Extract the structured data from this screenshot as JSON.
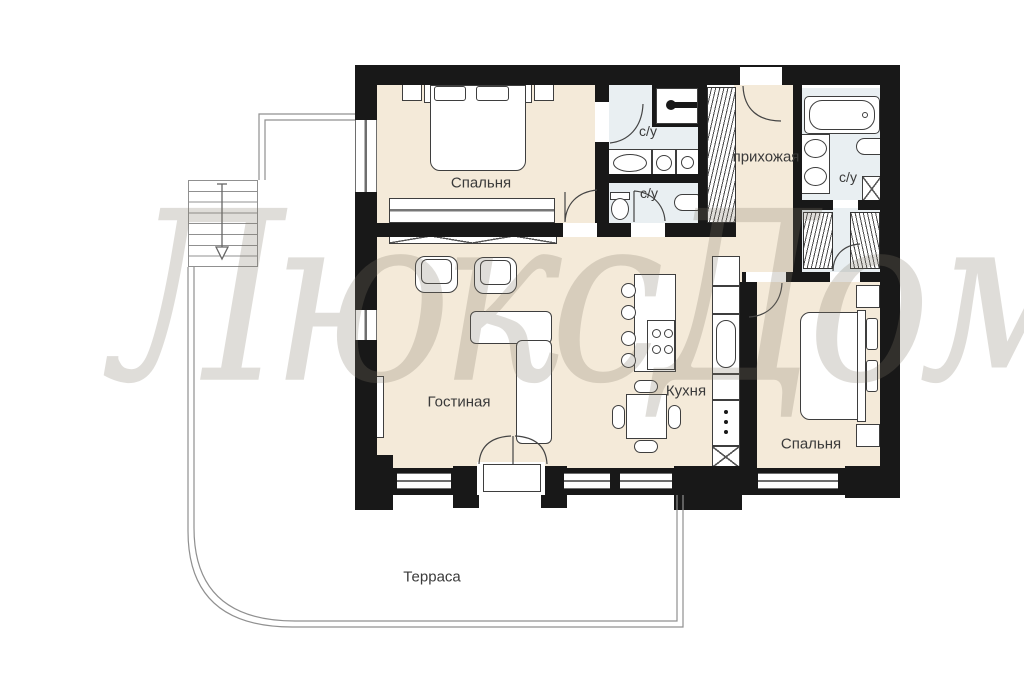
{
  "watermark": {
    "text": "ЛюксДом"
  },
  "rooms": {
    "bedroom1": {
      "label": "Спальня"
    },
    "bathroom_top": {
      "label": "с/у"
    },
    "bathroom_mid": {
      "label": "с/у"
    },
    "hallway": {
      "label": "прихожая"
    },
    "bathroom_master": {
      "label": "с/у"
    },
    "living": {
      "label": "Гостиная"
    },
    "kitchen": {
      "label": "Кухня"
    },
    "bedroom2": {
      "label": "Спальня"
    },
    "terrace": {
      "label": "Терраса"
    }
  },
  "colors": {
    "wall": "#181818",
    "floor": "#f4ead9",
    "bath": "#e9eff2",
    "stroke": "#3e3e3e",
    "outline": "#909090",
    "label": "#3a3a3a",
    "watermark": "rgba(128,120,102,0.25)"
  }
}
